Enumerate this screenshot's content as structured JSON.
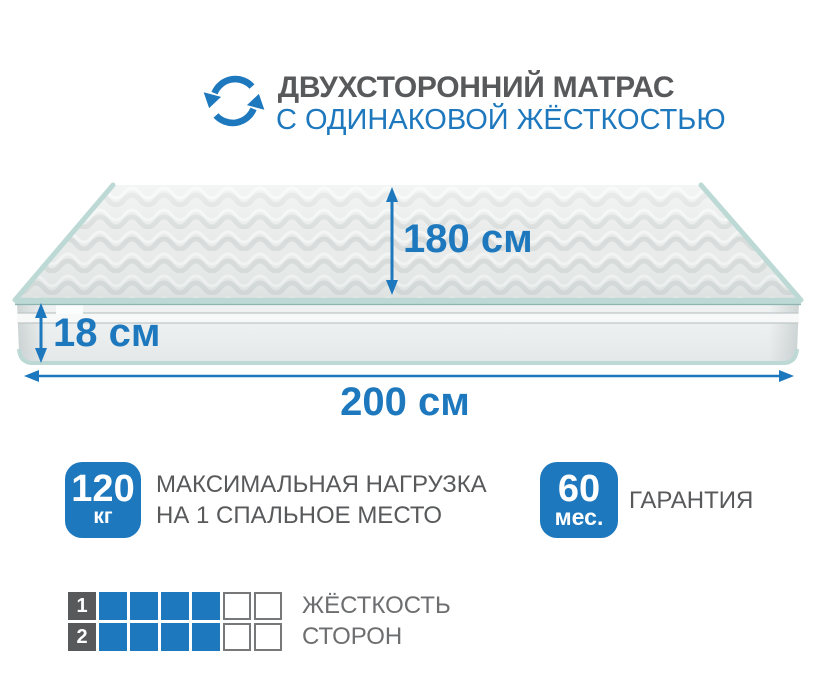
{
  "colors": {
    "accent_blue": "#1e78bd",
    "title_gray": "#58595b",
    "label_gray": "#6d6e70",
    "square_dark": "#58595b",
    "piping_teal": "#bcd9d5"
  },
  "header": {
    "icon": "flip-arrows-icon",
    "title": "ДВУХСТОРОННИЙ МАТРАС",
    "subtitle": "С ОДИНАКОВОЙ ЖЁСТКОСТЬЮ"
  },
  "mattress": {
    "depth_label": "180 см",
    "height_label": "18 см",
    "width_label": "200 см"
  },
  "badges": [
    {
      "value": "120",
      "unit": "кг",
      "line1": "МАКСИМАЛЬНАЯ НАГРУЗКА",
      "line2": "НА 1 СПАЛЬНОЕ МЕСТО"
    },
    {
      "value": "60",
      "unit": "мес.",
      "line1": "ГАРАНТИЯ",
      "line2": ""
    }
  ],
  "firmness": {
    "rows": [
      {
        "number": "1",
        "filled": 4,
        "total": 6,
        "label": "ЖЁСТКОСТЬ"
      },
      {
        "number": "2",
        "filled": 4,
        "total": 6,
        "label": "СТОРОН"
      }
    ]
  }
}
